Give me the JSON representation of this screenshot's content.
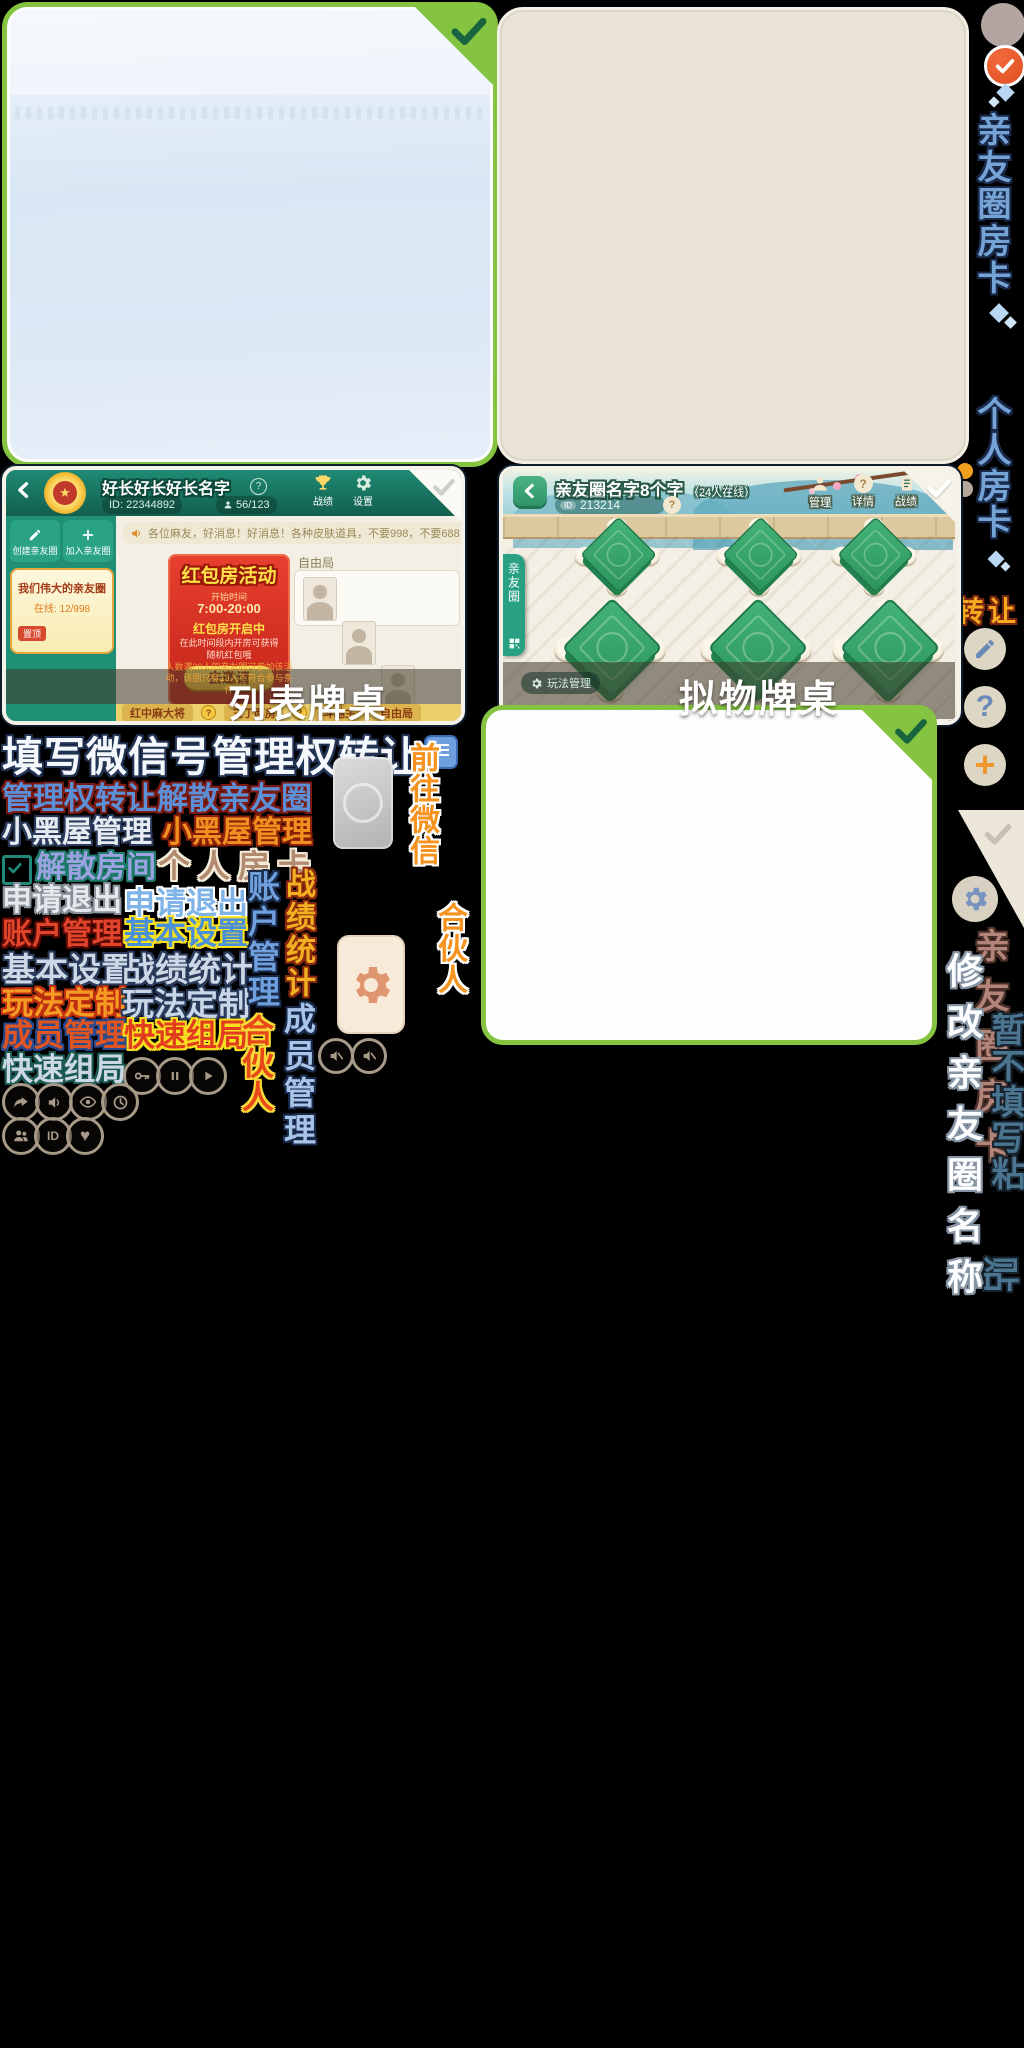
{
  "marks": {
    "question": "?",
    "plus": "+",
    "id": "ID",
    "back": "❮"
  },
  "rail": {
    "circle_card_label": "亲友圈房卡",
    "personal_card_label": "个人房卡",
    "transfer_label": "转让",
    "fold_card_label": "亲友圈房卡",
    "modify_name_label": "修改亲友圈名称",
    "skip_fill_label": "暂不填写粘",
    "paste_char": "贴"
  },
  "screenshot_list": {
    "caption": "列表牌桌",
    "header": {
      "title": "好长好长好长名字",
      "id": "ID: 22344892",
      "members": "56/123",
      "stats": "战绩",
      "settings": "设置"
    },
    "sidebar": {
      "create": "创建亲友圈",
      "join": "加入亲友圈",
      "card_title": "我们伟大的亲友圈",
      "online": "在线: 12/998",
      "pin": "置顶"
    },
    "marquee": "各位麻友，好消息！好消息！各种皮肤道具，不要998，不要688，只要98元，只要98元！",
    "promo": {
      "title": "红包房活动",
      "time_caption": "开始时间",
      "time": "7:00-20:00",
      "status": "红包房开启中",
      "desc": "在此时间段内开房可获得随机红包哦",
      "button": "去邀请",
      "note": "人数满20人的亲友圈可参加该活动，该圈只有13人不符合参与条件"
    },
    "free_label": "自由局",
    "tabs": [
      {
        "label": "红中麻大将"
      },
      {
        "label": "三丁两房"
      },
      {
        "label": "斗地主"
      },
      {
        "label": "自由局"
      }
    ]
  },
  "screenshot_physical": {
    "caption": "拟物牌桌",
    "title": "亲友圈名字8个字",
    "online": "（24人在线）",
    "room_id": "213214",
    "actions": [
      {
        "label": "管理"
      },
      {
        "label": "详情"
      },
      {
        "label": "战绩"
      }
    ],
    "side_tab": "亲友圈",
    "manage_button": "玩法管理"
  },
  "sprites": {
    "fill_wechat": "填写微信号管理权转让",
    "transfer_dissolve": "管理权转让解散亲友圈",
    "blackroom_a": "小黑屋管理",
    "blackroom_b": "小黑屋管理",
    "dissolve_room": "解散房间",
    "personal_card": "个人房卡",
    "apply_exit_a": "申请退出",
    "apply_exit_b": "申请退出",
    "account_mgmt": "账户管理",
    "basic_settings_a": "基本设置",
    "basic_settings_b": "基本设置",
    "stats": "战绩统计",
    "custom_a": "玩法定制",
    "custom_b": "玩法定制",
    "member_mgmt": "成员管理",
    "quick_a": "快速组局",
    "quick_b": "快速组局",
    "goto_wechat": "前往微信",
    "account_mgmt_v": "账户管理",
    "stats_v": "战绩统计",
    "member_mgmt_v": "成员管理",
    "partner_a": "合伙人",
    "partner_b": "合伙人"
  },
  "icon_names": {
    "rail": [
      "avatar-circle",
      "check-circle",
      "diamond-decor",
      "edit",
      "help",
      "add",
      "corner-check-fold",
      "gear"
    ],
    "media_row": [
      "key",
      "pause",
      "play",
      "share",
      "sound",
      "eye",
      "clock",
      "people",
      "id",
      "heart",
      "mute-speaker",
      "mute-speaker"
    ],
    "misc": [
      "list-detail",
      "cloud-tile",
      "gear-tile",
      "dissolve-brackets"
    ]
  },
  "colors": {
    "select_green": "#85c440",
    "check_green": "#17643e",
    "rail_blue": "#76a3d6",
    "transfer_gold": "#f6a81f",
    "header_teal": "#1f8a74",
    "promo_red": "#d6301f",
    "orange": "#f0962e"
  }
}
